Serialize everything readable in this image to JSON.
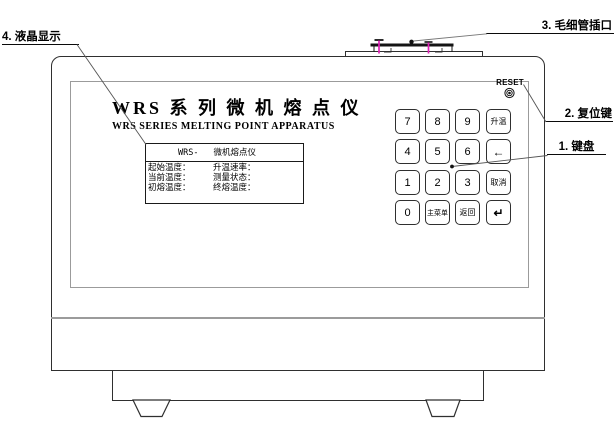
{
  "callouts": {
    "keyboard": "1. 键盘",
    "reset": "2. 复位键",
    "capillary": "3. 毛细管插口",
    "lcd": "4. 液晶显示"
  },
  "panel": {
    "title_cn": "WRS 系 列 微 机 熔 点 仪",
    "title_en": "WRS SERIES MELTING POINT APPARATUS",
    "reset_label": "RESET"
  },
  "lcd": {
    "model": "WRS-",
    "name": "微机熔点仪",
    "rows": [
      {
        "left": "起始温度：",
        "right": "升温速率："
      },
      {
        "left": "当前温度：",
        "right": "测量状态："
      },
      {
        "left": "初熔温度：",
        "right": "终熔温度："
      }
    ]
  },
  "keypad": {
    "rows": [
      [
        "7",
        "8",
        "9",
        "升温"
      ],
      [
        "4",
        "5",
        "6",
        "←"
      ],
      [
        "1",
        "2",
        "3",
        "取消"
      ],
      [
        "0",
        "主菜单",
        "返回",
        "↵"
      ]
    ]
  },
  "colors": {
    "outline": "#2f2f2f",
    "panel_outline": "#9b9b9b",
    "leader_line": "#555555",
    "capillary_tube": "#e020b8"
  }
}
